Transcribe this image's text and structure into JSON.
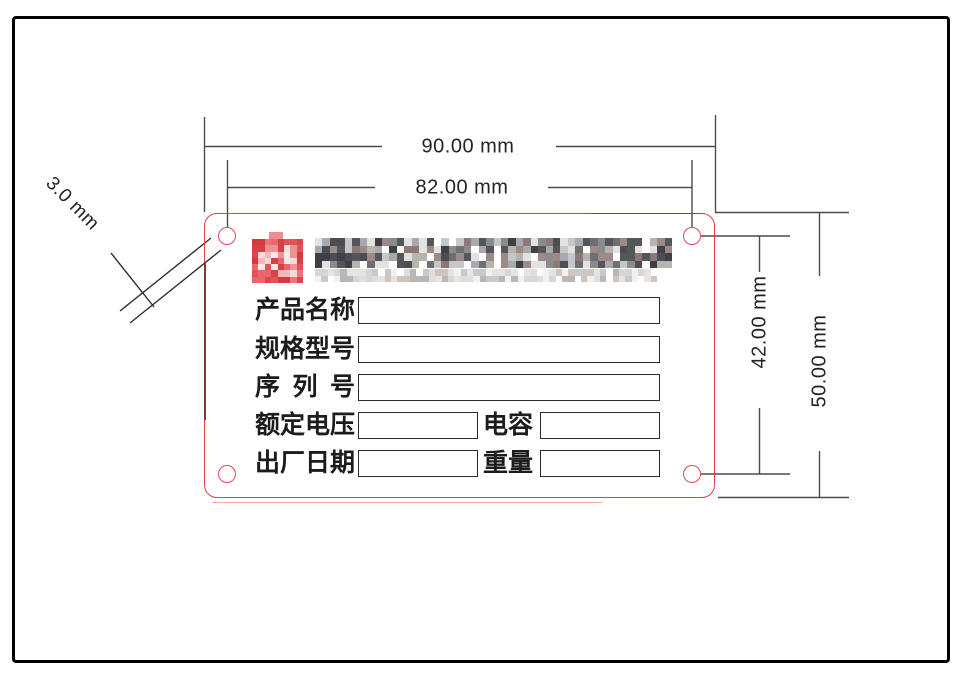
{
  "drawing": {
    "dimensions": {
      "plate_width": "90.00 mm",
      "hole_span_horizontal": "82.00 mm",
      "plate_height": "50.00 mm",
      "hole_span_vertical": "42.00 mm",
      "hole_diameter": "3.0 mm"
    },
    "plate": {
      "outline_color": "#de424b",
      "accent_color": "#7d393c",
      "line_color": "#4a4b4d"
    },
    "branding": {
      "redacted": true,
      "logo_edge_palette": [
        "#d63a41",
        "#de464d",
        "#e2535a",
        "#d94046",
        "#e8666c",
        "#ea757a"
      ],
      "logo_inner_palette": [
        "#e8666c",
        "#ef9296",
        "#f4b8ba",
        "#f9d9d9",
        "#e2535a",
        "#d94046",
        "#fbe9e9"
      ],
      "name_palette": [
        "#4c4d52",
        "#55565a",
        "#6e6f73",
        "#8a8b8f",
        "#a8a9ad",
        "#c6c7c9",
        "#e2e2e3",
        "#ffffff",
        "#8d7878",
        "#9b8a85",
        "#3f4043",
        "#b9b3ae"
      ],
      "sub_palette": [
        "#c9c9c9",
        "#d8d6d2",
        "#e6e4e0",
        "#b8b7b5",
        "#f2f1ef",
        "#ffffff",
        "#cfc5bc",
        "#dedede"
      ]
    },
    "fields": {
      "rows": [
        {
          "label": "产品名称"
        },
        {
          "label": "规格型号"
        },
        {
          "label": "序列号"
        },
        {
          "label": "额定电压",
          "label2": "电容"
        },
        {
          "label": "出厂日期",
          "label2": "重量"
        }
      ]
    }
  }
}
